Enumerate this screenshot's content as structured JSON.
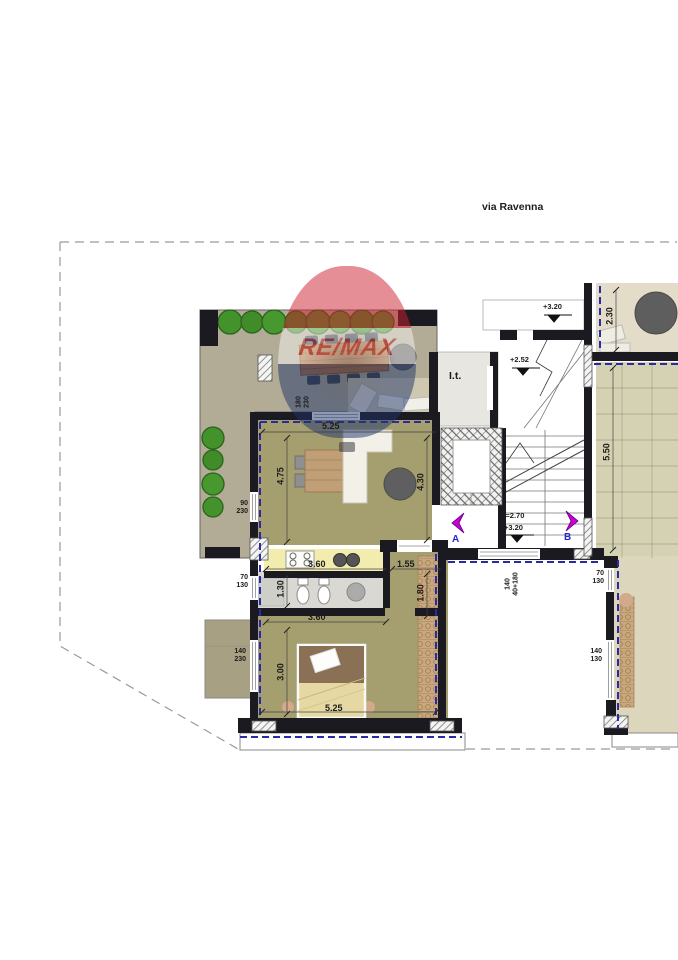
{
  "street": {
    "label": "via Ravenna"
  },
  "watermark": {
    "brand": "RE/MAX"
  },
  "labels": {
    "technical_room": "I.t.",
    "section_a": "A",
    "section_b": "B"
  },
  "levels": {
    "stair_top": "+3.20",
    "stair_mid": "+2.52",
    "hall_height": "H=2.70",
    "hall_level": "+3.20"
  },
  "dimensions": {
    "living_width": "5.25",
    "living_depth": "4.75",
    "living_right": "4.30",
    "kitchen_width": "3.60",
    "bath_depth": "1.30",
    "bath_width": "3.60",
    "hall_width": "1.55",
    "hall_depth": "1.80",
    "bedroom_depth": "3.00",
    "bedroom_width": "5.25",
    "balcony_depth": "2.30",
    "terrace_length": "5.50"
  },
  "window_specs": {
    "left_upper": {
      "w": "90",
      "h": "230"
    },
    "left_mid": {
      "w": "70",
      "h": "130"
    },
    "left_lower": {
      "w": "140",
      "h": "230"
    },
    "living_top": {
      "w": "180",
      "h": "230"
    },
    "hall_bottom": {
      "w": "140",
      "h": "40+180"
    },
    "right_upper": {
      "w": "70",
      "h": "130"
    },
    "right_lower": {
      "w": "140",
      "h": "130"
    }
  },
  "colors": {
    "wall": "#1a1a20",
    "insulation_dash": "#2a2aa8",
    "living_room": "#a59e6f",
    "terrace": "#b2ab95",
    "kitchen_counter": "#f2edae",
    "bathroom": "#d9d8d2",
    "tiled_terrace": "#d5d2b3",
    "balcony": "#e3dcc8",
    "neighbor_unit": "#dcd6bc",
    "greenery": "#44922c",
    "section_marker": "#cc00cc",
    "section_letter": "#2626cc",
    "watermark_red": "#cf1e2f",
    "watermark_blue": "#20356b"
  }
}
